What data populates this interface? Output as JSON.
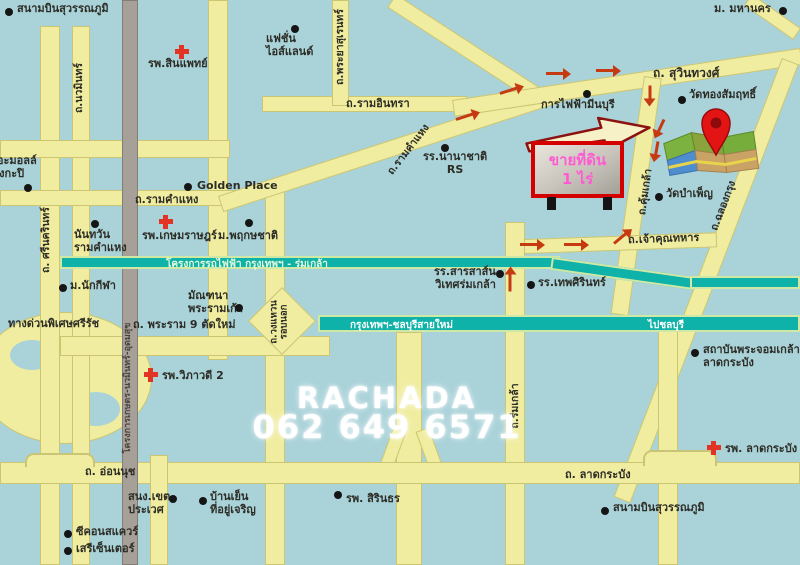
{
  "watermark": {
    "line1": "RACHADA",
    "line2": "062 649 6571"
  },
  "sign": {
    "line1": "ขายที่ดิน",
    "line2": "1 ไร่"
  },
  "transit": {
    "rail_project": "โครงการรถไฟฟ้า กรุงเทพฯ - ร่มเกล้า",
    "motorway": "กรุงเทพฯ-ชลบุรีสายใหม่",
    "to_chonburi": "ไปชลบุรี",
    "gray_road_project": "โครงการเกษตร-นวมินทร์-อุดมสุข"
  },
  "roads": {
    "nawamin": "ถ.นวมินทร์",
    "srinagarindra": "ถ. ศรีนครินทร์",
    "phraya_suren": "ถ.พระยาสุเรนทร์",
    "ram_inthra": "ถ.รามอินทรา",
    "ramkhamhaeng_diagonal": "ถ.รามคำแหง",
    "ramkhamhaeng": "ถ.รามคำแหง",
    "suwinthawong": "ถ. สุวินทวงศ์",
    "khum_klao": "ถ.คุ้มเกล้า",
    "chalong_krung": "ถ.ฉลองกรุง",
    "chao_khun_thahan": "ถ.เจ้าคุณทหาร",
    "romklao": "ถ.ร่มเกล้า",
    "ring_road": "ถ.วงแหวน\nรอบนอก",
    "rama9_new": "ถ. พระราม 9 ตัดใหม่",
    "expressway": "ทางด่วนพิเศษศรีรัช",
    "onnut": "ถ. อ่อนนุช",
    "lat_krabang": "ถ. ลาดกระบัง"
  },
  "places": {
    "airport_top": "สนามบินสุวรรณภูมิ",
    "sinphaet_hospital": "รพ.สินแพทย์",
    "fashion_island": "แฟชั่น\nไอส์แลนด์",
    "rs_school": "รร.นานาชาติ\nRS",
    "mahanakorn_university": "ม. มหานคร",
    "wat_thong_samrit": "วัดทองสัมฤทธิ์",
    "minburi_electricity": "การไฟฟ้ามีนบุรี",
    "wat_bamphen": "วัดบำเพ็ญ",
    "sarasas_school": "รร.สารสาส์น\nวิเทศร่มเกล้า",
    "thepsirin_school": "รร.เทพศิรินทร์",
    "golden_place": "Golden Place",
    "kasemrad_hospital": "รพ.เกษมราษฎร์",
    "phruekchat_village": "ม.พฤกษชาติ",
    "the_mall_bangkapi": "เดอะมอลล์\nบางกะปิ",
    "nantawan_village": "นันทวัน\nรามคำแหง",
    "nakkila_village": "ม.นักกีฬา",
    "manthana_village": "มัณฑนา\nพระรามเก้า",
    "viphavadi2_hospital": "รพ.วิภาวดี 2",
    "kmitl": "สถาบันพระจอมเกล้า\nลาดกระบัง",
    "lat_krabang_hospital": "รพ. ลาดกระบัง",
    "prawet_district_office": "สนง.เขต\nประเวศ",
    "baan_yen": "บ้านเย็น\nที่อยู่เจริญ",
    "seacon_square": "ซีคอนสแควร์",
    "seri_center": "เสรีเซ็นเตอร์",
    "sirindhorn_hospital": "รพ. สิรินธร",
    "airport_bottom": "สนามบินสุวรรณภูมิ"
  },
  "colors": {
    "water": "#a9d2d9",
    "road": "#f0eda0",
    "gray_road": "#a7a099",
    "canal_band": "#0fb2a8",
    "route_arrow": "#c63a12",
    "hospital_cross": "#e23425",
    "sign_border": "#d40000",
    "sign_text": "#ff5ad2",
    "watermark": "#ffffff"
  }
}
